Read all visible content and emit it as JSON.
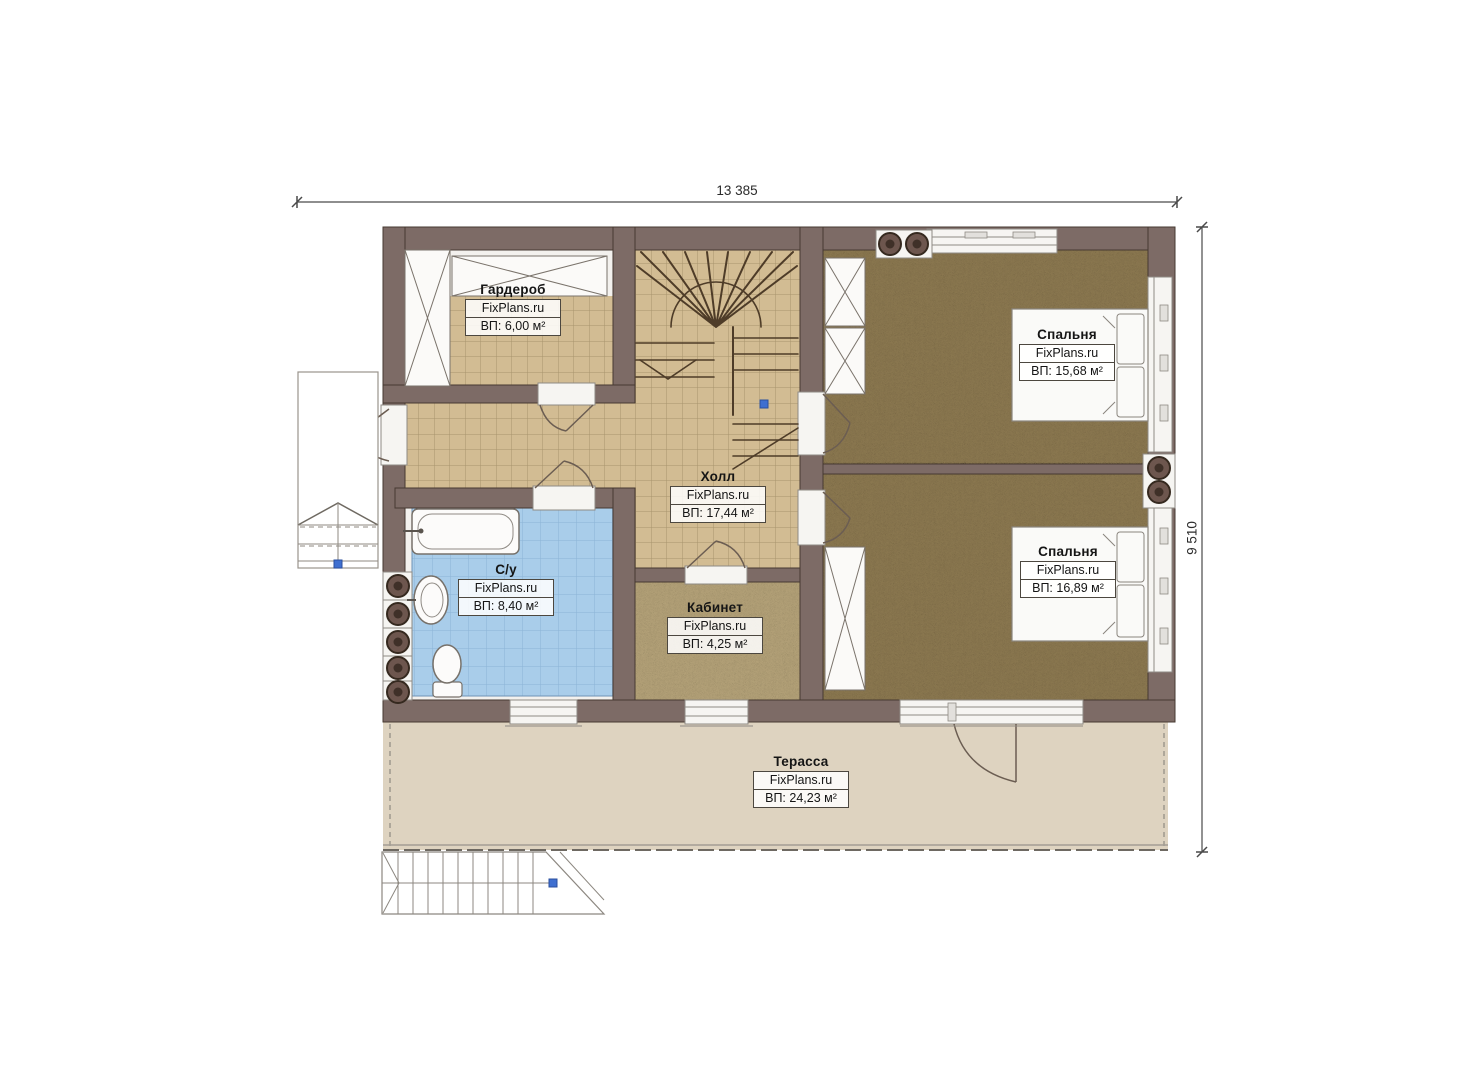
{
  "dimensions": {
    "width": "13 385",
    "height": "9 510"
  },
  "rooms": [
    {
      "name": "Гардероб",
      "brand": "FixPlans.ru",
      "area": "ВП: 6,00 м²"
    },
    {
      "name": "Холл",
      "brand": "FixPlans.ru",
      "area": "ВП: 17,44 м²"
    },
    {
      "name": "С/у",
      "brand": "FixPlans.ru",
      "area": "ВП: 8,40 м²"
    },
    {
      "name": "Кабинет",
      "brand": "FixPlans.ru",
      "area": "ВП: 4,25 м²"
    },
    {
      "name": "Спальня",
      "brand": "FixPlans.ru",
      "area": "ВП: 15,68 м²"
    },
    {
      "name": "Спальня",
      "brand": "FixPlans.ru",
      "area": "ВП: 16,89 м²"
    },
    {
      "name": "Терасса",
      "brand": "FixPlans.ru",
      "area": "ВП: 24,23 м²"
    }
  ],
  "icons": {
    "ventilation-icon": "filled double circle",
    "marker-dot-icon": "blue square",
    "closet-icon": "crossed rectangle"
  },
  "colors": {
    "wall": "#7d6b66",
    "wall_outline": "#463931",
    "tile_floor": "#d2bc93",
    "tile_grid": "#a8946d",
    "carpet": "#8a7750",
    "office_floor": "#b2a077",
    "bath_tile": "#a9cdea",
    "bath_grid": "#8cb4d6",
    "terrace": "#ded3c0",
    "fixture_white": "#fbfaf8",
    "marker_blue": "#3f6fd0",
    "vent_ring": "#6d564e",
    "dimension_line": "#4a4a4a"
  }
}
